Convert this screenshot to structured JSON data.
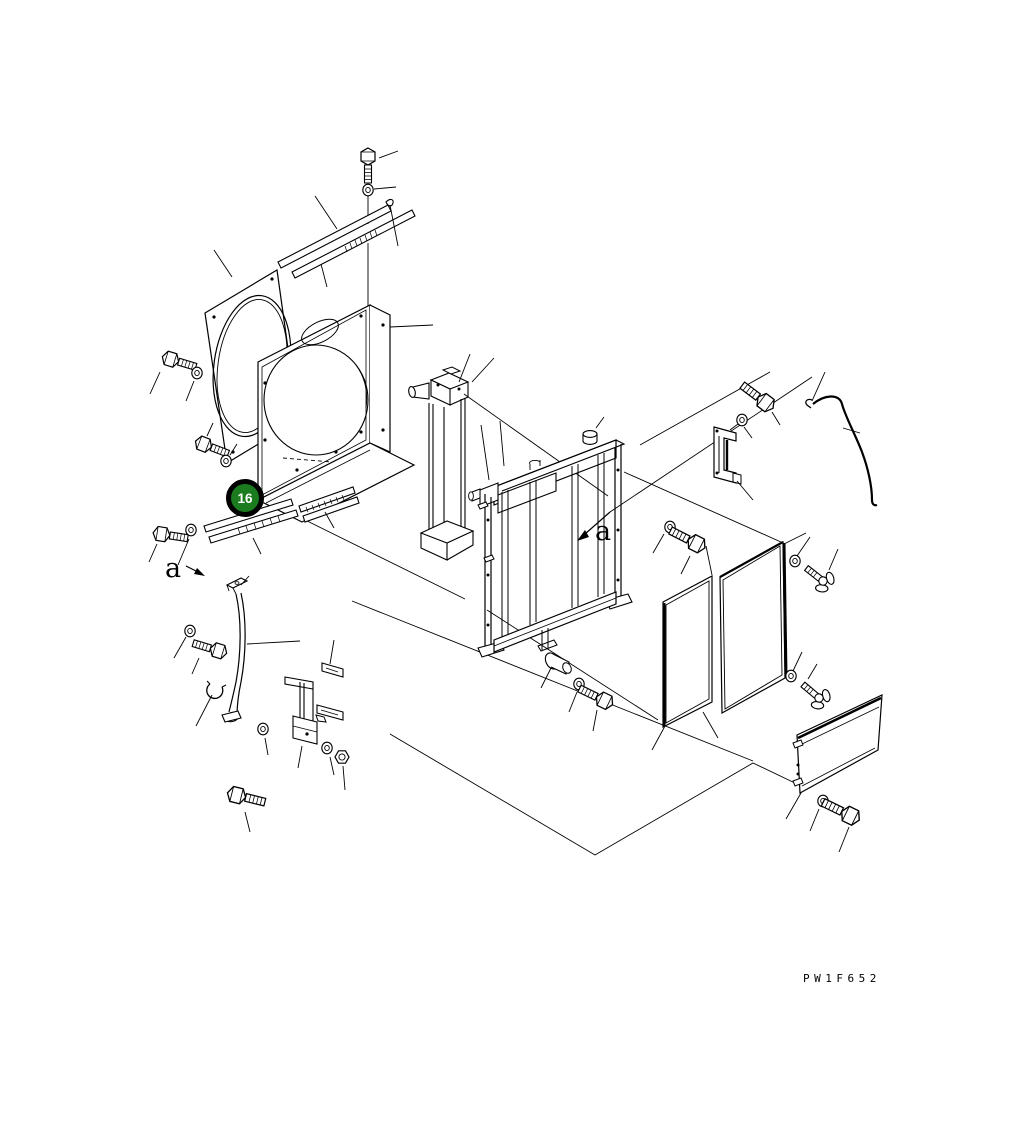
{
  "diagram": {
    "type_label": "exploded-parts-diagram",
    "drawing_code": "PW1F652",
    "balloon": {
      "number": "16",
      "fill_color": "#1a7c1e",
      "ring_color": "#000000",
      "text_color": "#ffffff"
    },
    "view_labels": {
      "left": "a",
      "right": "a"
    },
    "canvas": {
      "width": 1032,
      "height": 1130,
      "background": "#ffffff",
      "line_color": "#000000"
    },
    "depicted_parts": [
      "fan-guard-plate",
      "fan-shroud",
      "upper-seal-strip",
      "lower-seal-strip",
      "oil-cooler",
      "radiator-assembly",
      "filler-cap",
      "drain-elbow",
      "side-seal-left",
      "side-seal-right",
      "condenser-net-panel",
      "drain-pipe",
      "pipe-clamp",
      "mounting-bracket",
      "c-bracket",
      "rod-wire",
      "wing-bolt",
      "hex-bolt",
      "washer",
      "nut"
    ]
  }
}
